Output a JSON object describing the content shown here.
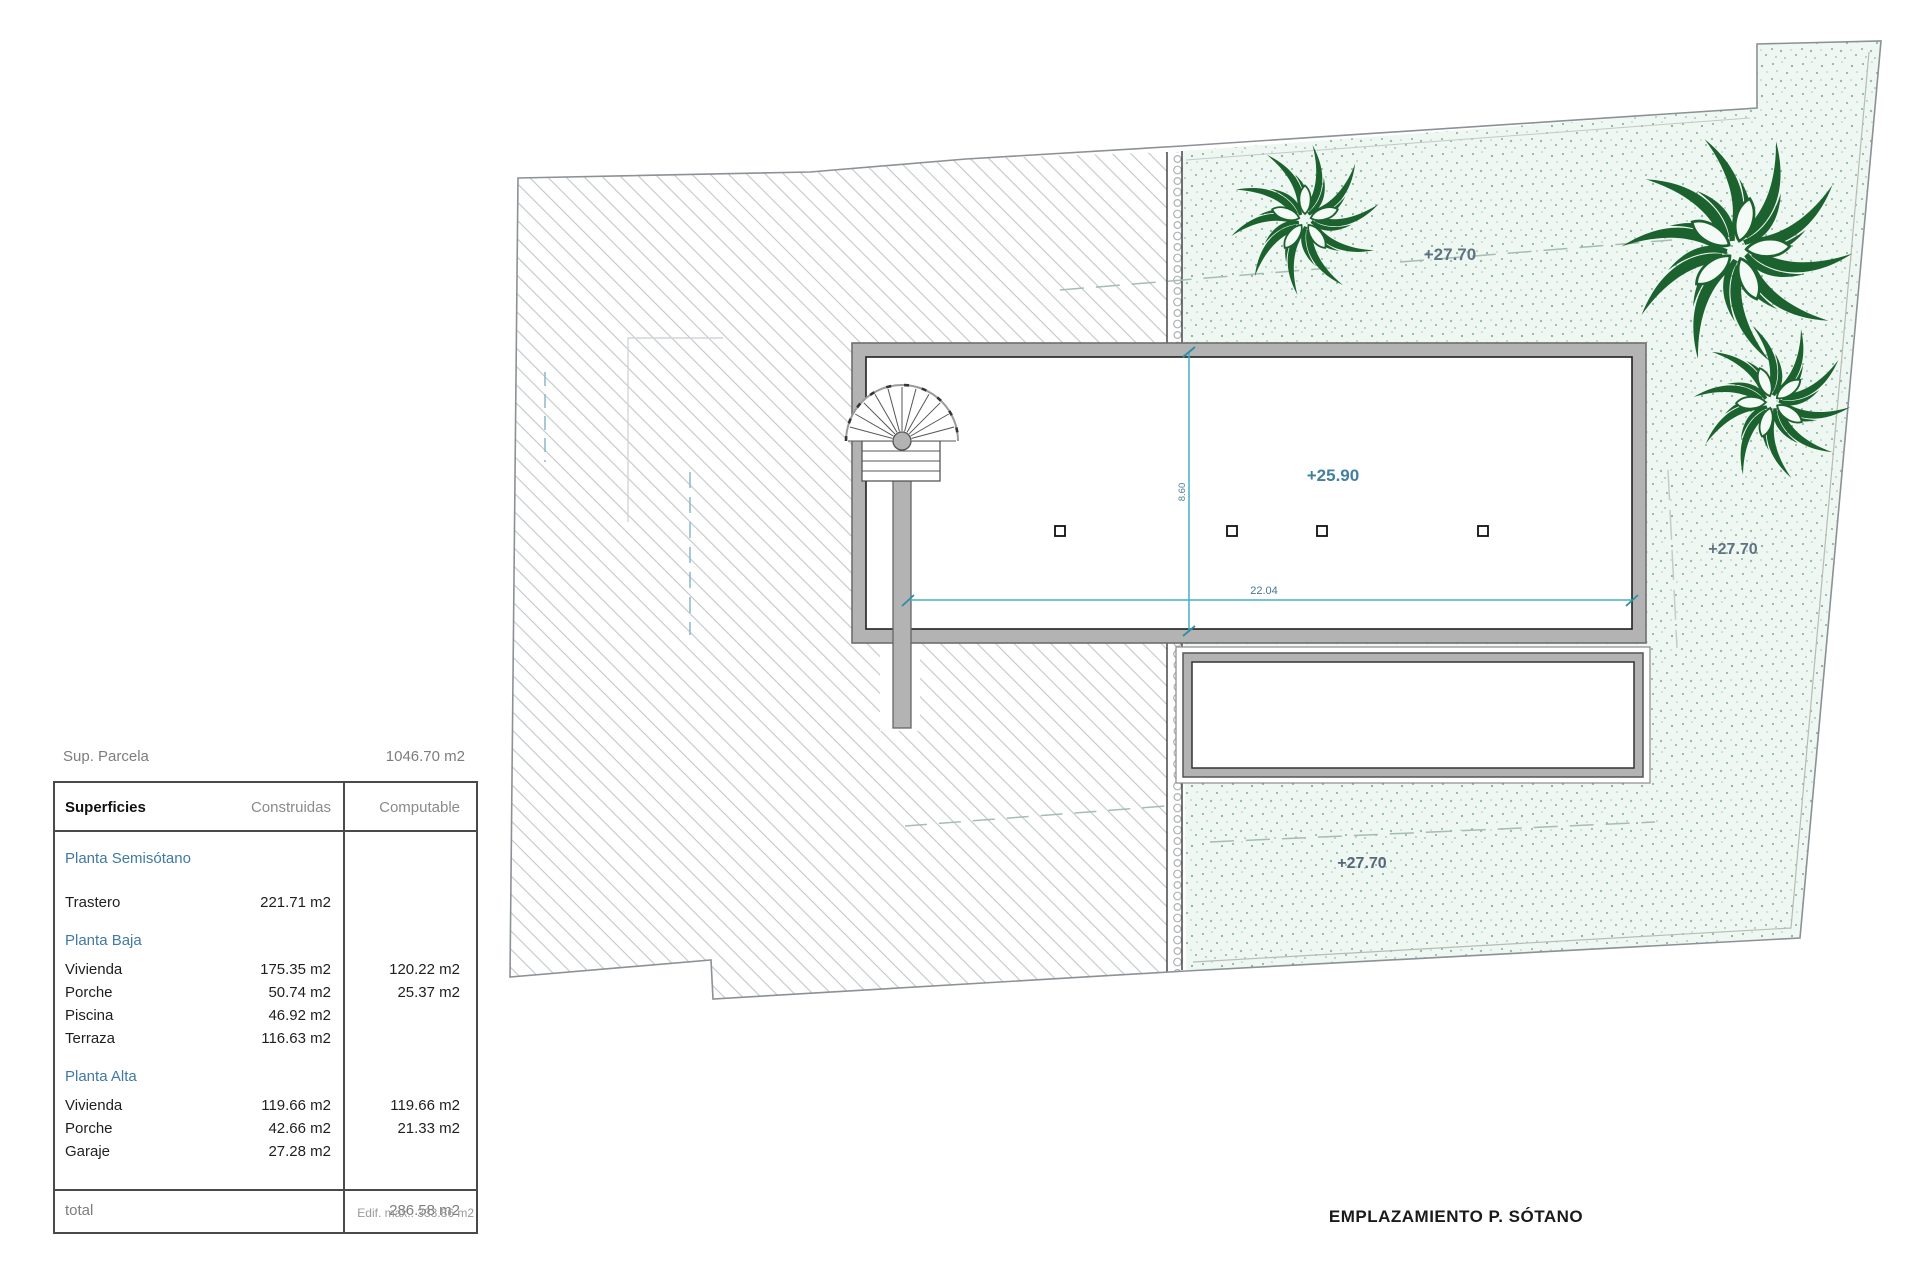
{
  "plan": {
    "caption": "EMPLAZAMIENTO P. SÓTANO",
    "levels": {
      "garden_top": "+27.70",
      "garden_right": "+27.70",
      "garden_bottom": "+27.70",
      "floor": "+25.90"
    },
    "dimensions": {
      "width": "22.04",
      "depth": "8.60"
    },
    "colors": {
      "wall_gray": "#b3b3b3",
      "dim_teal": "#45b0c4",
      "level_blue": "#5f7382",
      "plant_green": "#1c622e",
      "garden_tint": "#eef7f2"
    }
  },
  "summary": {
    "parcel_label": "Sup. Parcela",
    "parcel_value": "1046.70 m2",
    "edif_max": "Edif. max.: 333.86 m2",
    "table": {
      "headers": [
        "Superficies",
        "Construidas",
        "Computable"
      ],
      "sections": [
        {
          "title": "Planta Semisótano",
          "rows": [
            {
              "name": "Trastero",
              "construidas": "221.71 m2",
              "computable": ""
            }
          ]
        },
        {
          "title": "Planta Baja",
          "rows": [
            {
              "name": "Vivienda",
              "construidas": "175.35 m2",
              "computable": "120.22 m2"
            },
            {
              "name": "Porche",
              "construidas": "50.74 m2",
              "computable": "25.37 m2"
            },
            {
              "name": "Piscina",
              "construidas": "46.92 m2",
              "computable": ""
            },
            {
              "name": "Terraza",
              "construidas": "116.63 m2",
              "computable": ""
            }
          ]
        },
        {
          "title": "Planta Alta",
          "rows": [
            {
              "name": "Vivienda",
              "construidas": "119.66 m2",
              "computable": "119.66 m2"
            },
            {
              "name": "Porche",
              "construidas": "42.66 m2",
              "computable": "21.33 m2"
            },
            {
              "name": "Garaje",
              "construidas": "27.28 m2",
              "computable": ""
            }
          ]
        }
      ],
      "total_label": "total",
      "total_value": "286.58 m2"
    }
  }
}
